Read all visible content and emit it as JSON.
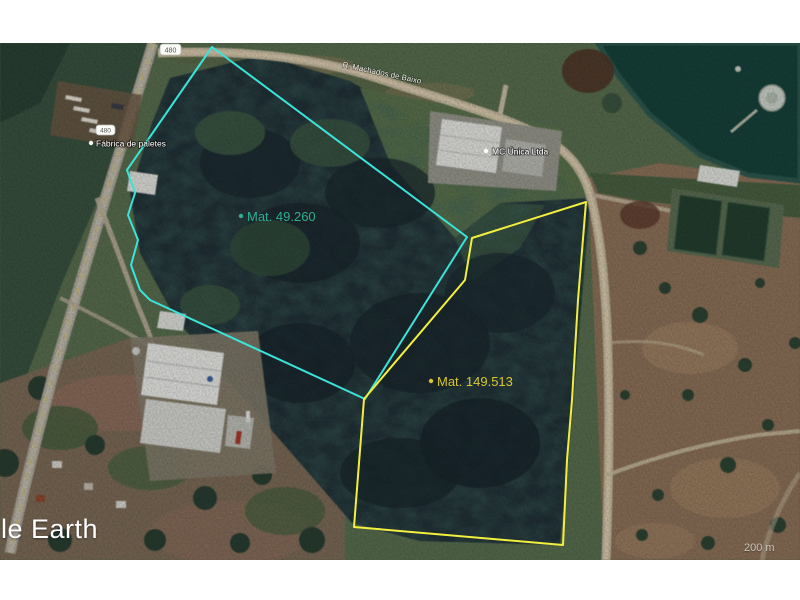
{
  "watermark": "le Earth",
  "scale": "200 m",
  "parcels": [
    {
      "label": "Mat. 49.260",
      "color": "#3be3d9",
      "label_color": "#2fae92",
      "points": "212,4 467,194 365,356 150,257 140,247 131,222 138,197 128,172 135,150 127,127"
    },
    {
      "label": "Mat. 149.513",
      "color": "#f2ef3e",
      "label_color": "#d9c72e",
      "points": "472,195 586,159 578,257 572,357 567,417 563,502 354,484 364,356 465,237"
    }
  ],
  "places": {
    "factory": "Fábrica de paletes",
    "business": "MC Única Ltda",
    "road": "R. Machados de Baixo",
    "shield1": "480",
    "shield2": "480"
  },
  "colors": {
    "water": "#17433b",
    "forest": "#223238",
    "pasture": "#8f745b",
    "road": "#cbbfa4",
    "cyan_parcel": "#3be3d9",
    "yellow_parcel": "#f2ef3e"
  }
}
